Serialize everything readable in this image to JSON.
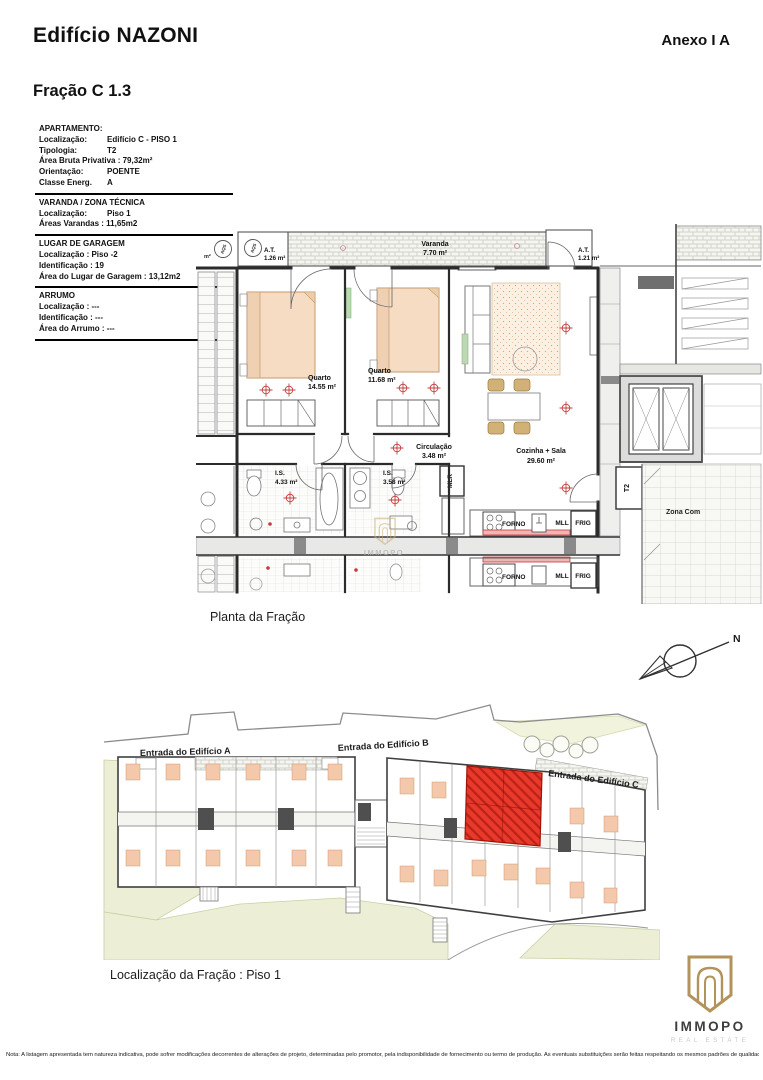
{
  "header": {
    "title": "Edifício NAZONI",
    "annex": "Anexo I A",
    "fraction": "Fração C 1.3"
  },
  "info": {
    "blocks": [
      {
        "title": "APARTAMENTO:",
        "rows": [
          {
            "label": "Localização:",
            "value": "Edifício C - PISO 1"
          },
          {
            "label": "Tipologia:",
            "value": "T2"
          },
          {
            "label": "Área Bruta Privativa : 79,32m²",
            "value": ""
          },
          {
            "label": "Orientação:",
            "value": "POENTE"
          },
          {
            "label": "Classe Energ.",
            "value": "A"
          }
        ]
      },
      {
        "title": "VARANDA / ZONA TÉCNICA",
        "rows": [
          {
            "label": "Localização:",
            "value": "Piso 1"
          },
          {
            "label": "Áreas Varandas : 11,65m2",
            "value": ""
          }
        ]
      },
      {
        "title": "LUGAR DE GARAGEM",
        "rows": [
          {
            "label": "Localização : Piso -2",
            "value": ""
          },
          {
            "label": "Identificação :  19",
            "value": ""
          },
          {
            "label": "Área do Lugar de Garagem : 13,12m2",
            "value": ""
          }
        ]
      },
      {
        "title": "ARRUMO",
        "rows": [
          {
            "label": "Localização : ---",
            "value": ""
          },
          {
            "label": "Identificação : ---",
            "value": ""
          },
          {
            "label": "Área do Arrumo : ---",
            "value": ""
          }
        ]
      }
    ]
  },
  "plan": {
    "caption": "Planta da Fração",
    "labels": {
      "varanda": "Varanda",
      "varanda_area": "7.70 m²",
      "at_left": "A.T.",
      "at_left_area": "1.26 m²",
      "at_right": "A.T.",
      "at_right_area": "1.21 m²",
      "aqs": "AQS",
      "edge_m2": "m²",
      "quarto1": "Quarto",
      "quarto1_area": "14.55 m²",
      "quarto2": "Quarto",
      "quarto2_area": "11.68 m²",
      "circulacao": "Circulação",
      "circulacao_area": "3.48 m²",
      "cozinha": "Cozinha + Sala",
      "cozinha_area": "29.60 m²",
      "is1": "I.S.",
      "is1_area": "4.33 m²",
      "is2": "I.S.",
      "is2_area": "3.58 m²",
      "mlr": "MLR",
      "forno": "FORNO",
      "mll": "MLL",
      "frig": "FRIG",
      "t2": "T2",
      "zona_comum": "Zona Com",
      "watermark": "IMMOPO"
    }
  },
  "site": {
    "caption": "Localização da Fração : Piso 1",
    "labels": {
      "entrada_a": "Entrada do Edifício A",
      "entrada_b": "Entrada do Edifício B",
      "entrada_c": "Entrada do Edifício C",
      "compass_n": "N"
    }
  },
  "logo": {
    "name": "IMMOPO",
    "tagline": "REAL ESTATE"
  },
  "footer": {
    "note": "Nota: A listagem apresentada tem natureza indicativa, pode sofrer modificações decorrentes de alterações de projeto, determinadas pelo promotor, pela indisponibilidade de fornecimento ou termo de produção. As eventuais substituições serão feitas respeitando os mesmos padrões de qualidade."
  },
  "colors": {
    "highlight_red": "#e8392b",
    "counter_red": "#bf3a3a",
    "bed_tan": "#f4c8ab",
    "green_area": "#ecefd5",
    "logo_gold": "#b2935b",
    "line_dark": "#2b2b2b"
  }
}
